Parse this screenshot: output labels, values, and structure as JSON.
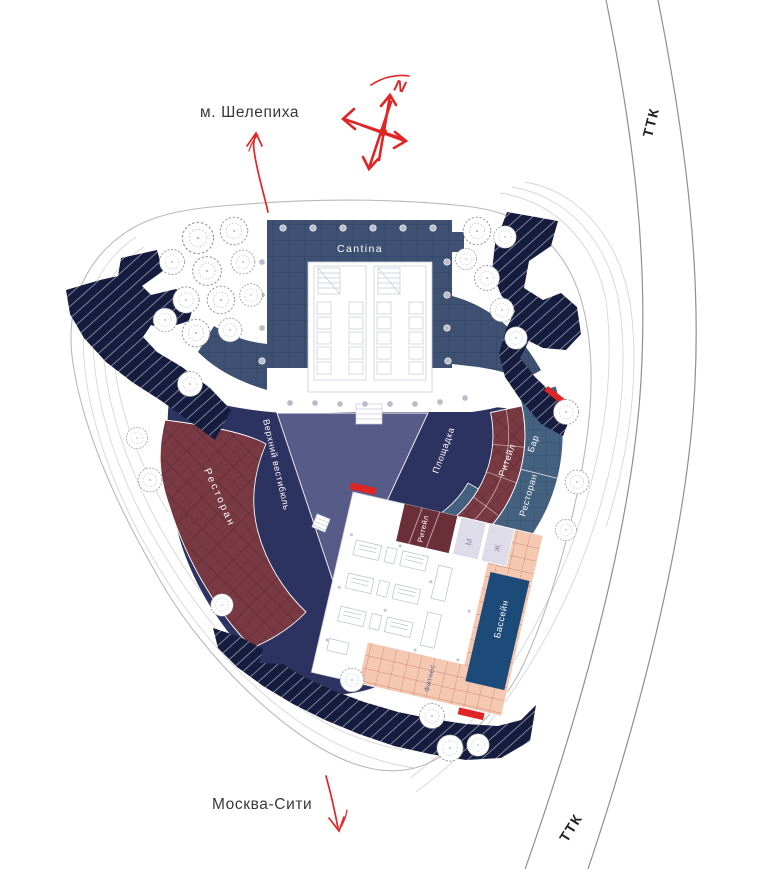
{
  "map": {
    "metro_label": "м. Шелепиха",
    "city_label": "Москва-Сити",
    "road_label_top": "ТТК",
    "road_label_bottom": "ТТК",
    "north_label": "N"
  },
  "zones": {
    "cantina": "Cantina",
    "upper_vestibule": "Верхний вестибюль",
    "restaurant_left": "Ресторан",
    "plaza": "Площадка",
    "retail_band": "Ритейл",
    "bar": "Бар",
    "restaurant_right": "Ресторан",
    "retail_block": "Ритейл",
    "wc_men": "М",
    "wc_women": "Ж",
    "pool": "Бассейн",
    "fitness": "Фитнес"
  },
  "colors": {
    "accent_red": "#e02526",
    "navy_dark": "#151c3e",
    "indigo": "#2d3361",
    "steel_blue": "#3e5173",
    "steel_blue_band": "#44617f",
    "slate_purple": "#575b88",
    "maroon": "#7a3a44",
    "maroon_dark": "#6b2f3a",
    "pink": "#f5c8b1",
    "pink_line": "#c4756a",
    "pool_blue": "#1d4b79",
    "lavender": "#dfdcea",
    "road_gray": "#8f8f8f",
    "text_dark": "#333333"
  }
}
